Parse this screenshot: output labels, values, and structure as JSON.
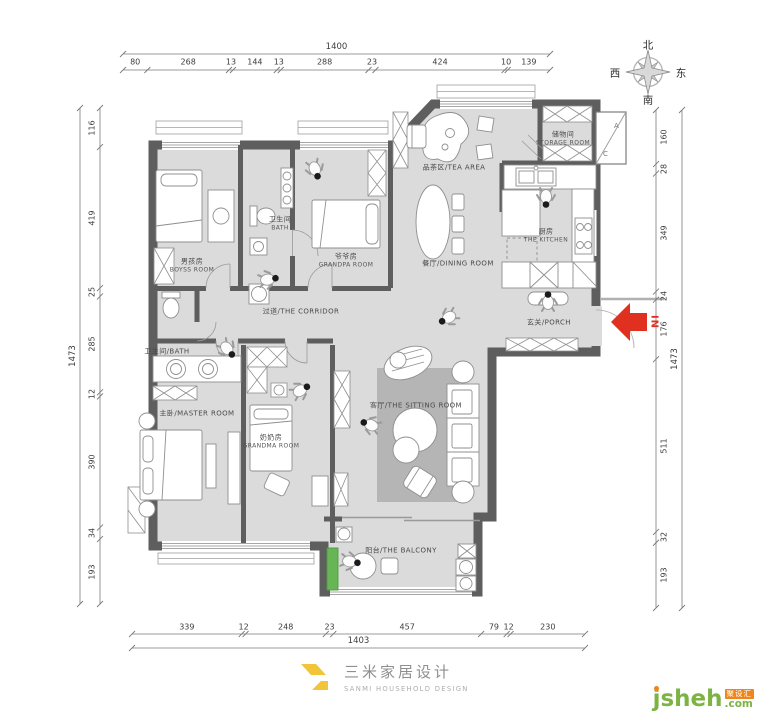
{
  "compass": {
    "north": "北",
    "east": "东",
    "south": "南",
    "west": "西"
  },
  "entrance": {
    "label": "IN"
  },
  "ac_shaft": {
    "labels": [
      "A",
      "C"
    ]
  },
  "rooms": [
    {
      "id": "boys-room",
      "zh": "男孩房",
      "en": "BOYSS ROOM",
      "layout": "stack"
    },
    {
      "id": "bath-upper",
      "zh": "卫生间",
      "en": "BATH",
      "layout": "stack"
    },
    {
      "id": "grandpa-room",
      "zh": "爷爷房",
      "en": "GRANDPA ROOM",
      "layout": "stack"
    },
    {
      "id": "tea-area",
      "zh": "品茶区",
      "en": "TEA AREA",
      "layout": "inline"
    },
    {
      "id": "storage-room",
      "zh": "储物间",
      "en": "STORAGE ROOM",
      "layout": "stack"
    },
    {
      "id": "kitchen",
      "zh": "厨房",
      "en": "THE KITCHEN",
      "layout": "stack"
    },
    {
      "id": "dining-room",
      "zh": "餐厅",
      "en": "DINING ROOM",
      "layout": "inline"
    },
    {
      "id": "corridor",
      "zh": "过道",
      "en": "THE CORRIDOR",
      "layout": "inline"
    },
    {
      "id": "porch",
      "zh": "玄关",
      "en": "PORCH",
      "layout": "inline"
    },
    {
      "id": "bath-lower",
      "zh": "卫生间",
      "en": "BATH",
      "layout": "inline"
    },
    {
      "id": "master-room",
      "zh": "主卧",
      "en": "MASTER ROOM",
      "layout": "inline"
    },
    {
      "id": "grandma-room",
      "zh": "奶奶房",
      "en": "GRANDMA ROOM",
      "layout": "stack"
    },
    {
      "id": "sitting-room",
      "zh": "客厅",
      "en": "THE SITTING ROOM",
      "layout": "inline"
    },
    {
      "id": "balcony",
      "zh": "阳台",
      "en": "THE BALCONY",
      "layout": "inline"
    }
  ],
  "dimensions": {
    "top": {
      "total": "1400",
      "segments": [
        "80",
        "268",
        "13",
        "144",
        "13",
        "288",
        "23",
        "424",
        "10",
        "139"
      ]
    },
    "bottom": {
      "total": "1403",
      "segments": [
        "339",
        "12",
        "248",
        "23",
        "457",
        "79",
        "12",
        "230"
      ]
    },
    "left": {
      "total": "1473",
      "segments": [
        "116",
        "419",
        "25",
        "285",
        "12",
        "390",
        "34",
        "193"
      ]
    },
    "right": {
      "total": "1473",
      "segments": [
        "160",
        "28",
        "349",
        "24",
        "176",
        "511",
        "32",
        "193"
      ]
    }
  },
  "footer": {
    "logo_zh": "三米家居设计",
    "logo_en": "SANMI HOUSEHOLD DESIGN"
  },
  "watermark": {
    "brand": "jsheh",
    "tld": ".com",
    "badge": "聚设汇"
  },
  "colors": {
    "wall": "#5e5e5e",
    "floor": "#dbdbdb",
    "rug": "#b5b5b5",
    "accent_red": "#e0301f",
    "logo_yellow": "#f2c437",
    "watermark_green": "#7cb342",
    "watermark_orange": "#f08519",
    "plant_green": "#67b554"
  }
}
